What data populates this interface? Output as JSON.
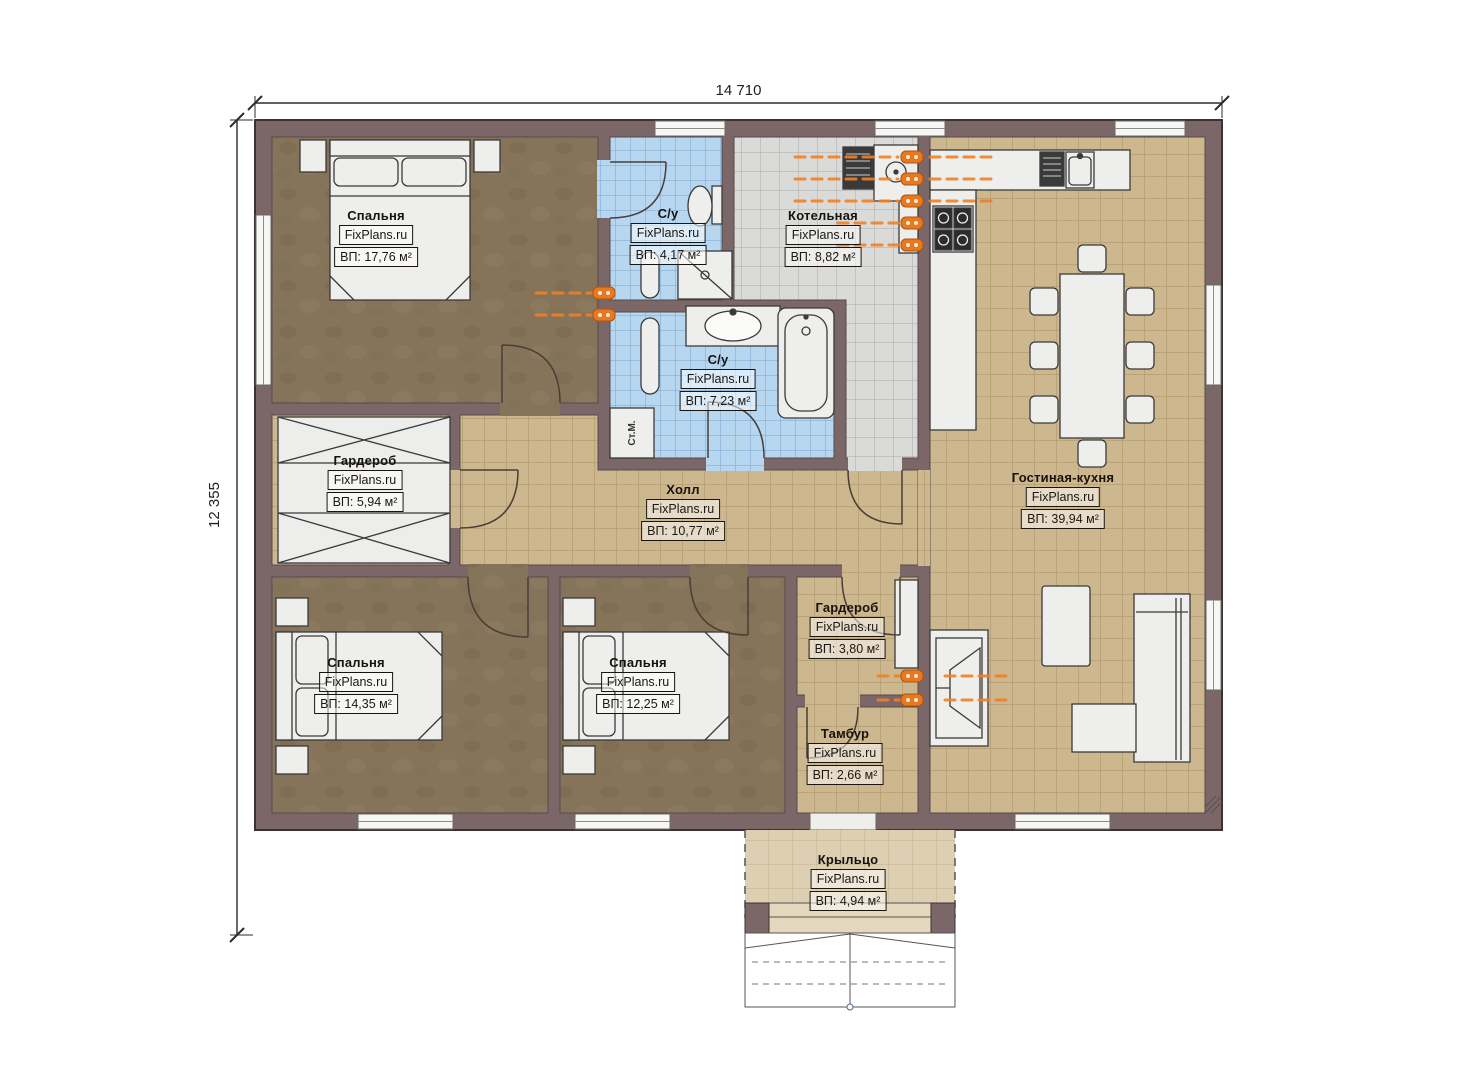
{
  "dimensions": {
    "width": "14 710",
    "height": "12 355"
  },
  "rooms": [
    {
      "id": "bedroom-1",
      "name": "Спальня",
      "brand": "FixPlans.ru",
      "area": "ВП: 17,76 м²"
    },
    {
      "id": "bathroom-1",
      "name": "С/у",
      "brand": "FixPlans.ru",
      "area": "ВП: 4,17 м²"
    },
    {
      "id": "boiler-room",
      "name": "Котельная",
      "brand": "FixPlans.ru",
      "area": "ВП: 8,82 м²"
    },
    {
      "id": "bathroom-2",
      "name": "С/у",
      "brand": "FixPlans.ru",
      "area": "ВП: 7,23 м²"
    },
    {
      "id": "wardrobe-1",
      "name": "Гардероб",
      "brand": "FixPlans.ru",
      "area": "ВП: 5,94 м²"
    },
    {
      "id": "hall",
      "name": "Холл",
      "brand": "FixPlans.ru",
      "area": "ВП: 10,77 м²"
    },
    {
      "id": "living-kitchen",
      "name": "Гостиная-кухня",
      "brand": "FixPlans.ru",
      "area": "ВП: 39,94 м²"
    },
    {
      "id": "bedroom-2",
      "name": "Спальня",
      "brand": "FixPlans.ru",
      "area": "ВП: 14,35 м²"
    },
    {
      "id": "bedroom-3",
      "name": "Спальня",
      "brand": "FixPlans.ru",
      "area": "ВП: 12,25 м²"
    },
    {
      "id": "wardrobe-2",
      "name": "Гардероб",
      "brand": "FixPlans.ru",
      "area": "ВП: 3,80 м²"
    },
    {
      "id": "vestibule",
      "name": "Тамбур",
      "brand": "FixPlans.ru",
      "area": "ВП: 2,66 м²"
    },
    {
      "id": "porch",
      "name": "Крыльцо",
      "brand": "FixPlans.ru",
      "area": "ВП: 4,94 м²"
    }
  ],
  "annotations": {
    "washing_machine": "Ст.М."
  },
  "colors": {
    "wall": "#7b6668",
    "floor_wood": "#85745a",
    "tile_tan": "#cdb78e",
    "tile_blue": "#b7d7f1",
    "tile_gray": "#dadad8",
    "porch_floor": "#dccfb2",
    "heating_accent": "#e8791f"
  }
}
